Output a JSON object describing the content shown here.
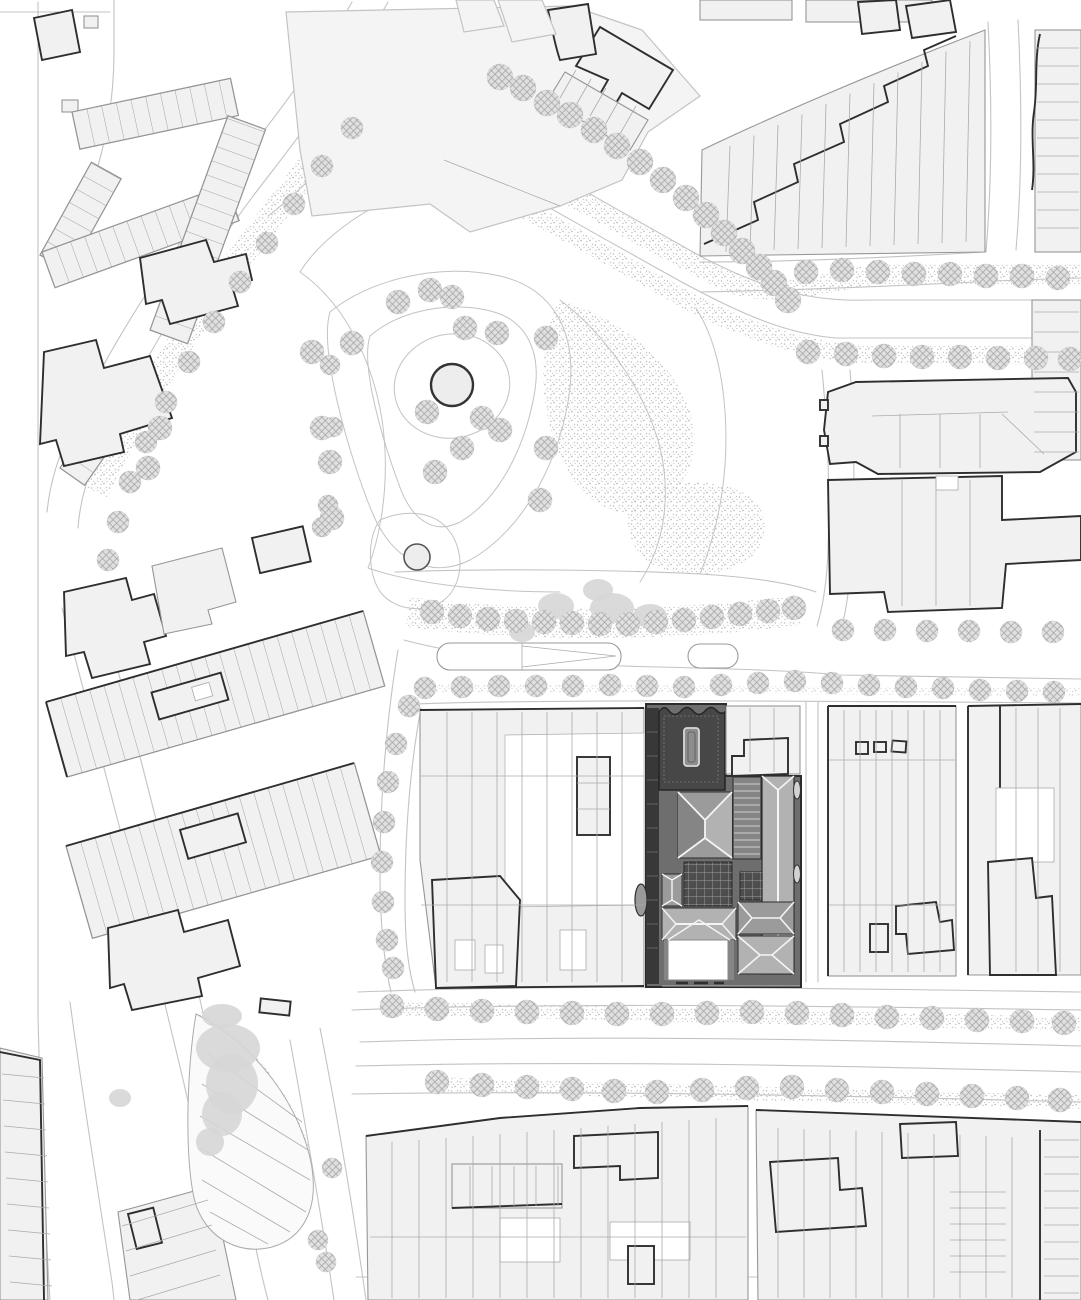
{
  "map": {
    "kind": "architectural-site-plan",
    "view": "roof-plan-black-and-white",
    "highlighted_site": "dark-roofscape-building-center-right",
    "colors": {
      "paper": "#ffffff",
      "lineLight": "#c3c3c3",
      "lineMid": "#969696",
      "lineBold": "#2e2e2e",
      "blockFill": "#f1f1f1",
      "blockFill2": "#f4f4f4",
      "parcel": "#ababab",
      "treeBase": "#e0e0e0",
      "treeHatch": "#a5a5a5",
      "blob": "#d6d6d6",
      "stipple": "#bdbdbd",
      "siteBase": "#6e6e6e",
      "siteDark": "#474747",
      "siteDarker": "#383838",
      "roofLight": "#b2b2b2",
      "roofMid": "#9b9b9b",
      "roofDark": "#858585",
      "plaid": "#4e4e4e",
      "plaidLine": "#9e9e9e",
      "ridge": "#f4f4f4"
    },
    "trees": {
      "rows": [
        {
          "id": "avenue-diagonal",
          "r": 13,
          "pts": [
            [
              500,
              77
            ],
            [
              523,
              88
            ],
            [
              547,
              103
            ],
            [
              570,
              115
            ],
            [
              594,
              130
            ],
            [
              617,
              146
            ],
            [
              640,
              162
            ],
            [
              663,
              180
            ],
            [
              686,
              198
            ],
            [
              706,
              215
            ],
            [
              724,
              233
            ],
            [
              742,
              251
            ],
            [
              759,
              267
            ],
            [
              774,
              283
            ],
            [
              788,
              300
            ]
          ]
        },
        {
          "id": "avenue-north-verge",
          "r": 12,
          "pts": [
            [
              806,
              272
            ],
            [
              842,
              270
            ],
            [
              878,
              272
            ],
            [
              914,
              274
            ],
            [
              950,
              274
            ],
            [
              986,
              276
            ],
            [
              1022,
              276
            ],
            [
              1058,
              278
            ]
          ]
        },
        {
          "id": "avenue-south-verge",
          "r": 12,
          "pts": [
            [
              808,
              352
            ],
            [
              846,
              354
            ],
            [
              884,
              356
            ],
            [
              922,
              357
            ],
            [
              960,
              357
            ],
            [
              998,
              358
            ],
            [
              1036,
              358
            ],
            [
              1070,
              359
            ]
          ]
        },
        {
          "id": "canal-bank",
          "r": 11,
          "pts": [
            [
              352,
              128
            ],
            [
              322,
              166
            ],
            [
              294,
              204
            ],
            [
              267,
              243
            ],
            [
              240,
              282
            ],
            [
              214,
              322
            ],
            [
              189,
              362
            ],
            [
              166,
              402
            ],
            [
              146,
              442
            ],
            [
              130,
              482
            ],
            [
              118,
              522
            ],
            [
              108,
              560
            ]
          ]
        },
        {
          "id": "canal-east-bank",
          "r": 10,
          "pts": [
            [
              330,
              365
            ],
            [
              333,
              427
            ],
            [
              328,
              505
            ],
            [
              322,
              527
            ]
          ]
        },
        {
          "id": "park",
          "r": 12,
          "pts": [
            [
              430,
              290
            ],
            [
              452,
              297
            ],
            [
              398,
              302
            ],
            [
              352,
              343
            ],
            [
              312,
              352
            ],
            [
              465,
              328
            ],
            [
              497,
              333
            ],
            [
              546,
              338
            ],
            [
              482,
              418
            ],
            [
              427,
              412
            ],
            [
              462,
              448
            ],
            [
              500,
              430
            ],
            [
              546,
              448
            ],
            [
              435,
              472
            ],
            [
              322,
              428
            ],
            [
              330,
              462
            ],
            [
              332,
              518
            ],
            [
              540,
              500
            ],
            [
              160,
              428
            ],
            [
              148,
              468
            ]
          ]
        },
        {
          "id": "park-boulevard",
          "r": 12,
          "pts": [
            [
              432,
              612
            ],
            [
              460,
              616
            ],
            [
              488,
              619
            ],
            [
              516,
              621
            ],
            [
              544,
              622
            ],
            [
              572,
              623
            ],
            [
              600,
              624
            ],
            [
              628,
              624
            ],
            [
              656,
              622
            ],
            [
              684,
              620
            ],
            [
              712,
              617
            ],
            [
              740,
              614
            ],
            [
              768,
              611
            ],
            [
              794,
              608
            ]
          ]
        },
        {
          "id": "site-street",
          "r": 11,
          "pts": [
            [
              425,
              688
            ],
            [
              462,
              687
            ],
            [
              499,
              686
            ],
            [
              536,
              686
            ],
            [
              573,
              686
            ],
            [
              610,
              685
            ],
            [
              647,
              686
            ],
            [
              684,
              687
            ],
            [
              721,
              685
            ],
            [
              758,
              683
            ],
            [
              795,
              681
            ],
            [
              832,
              683
            ],
            [
              869,
              685
            ],
            [
              906,
              687
            ],
            [
              943,
              688
            ],
            [
              980,
              690
            ],
            [
              1017,
              691
            ],
            [
              1054,
              692
            ]
          ]
        },
        {
          "id": "west-leg-street",
          "r": 11,
          "pts": [
            [
              409,
              706
            ],
            [
              396,
              744
            ],
            [
              388,
              782
            ],
            [
              384,
              822
            ],
            [
              382,
              862
            ],
            [
              383,
              902
            ],
            [
              387,
              940
            ],
            [
              393,
              968
            ]
          ]
        },
        {
          "id": "right-blocks-street",
          "r": 11,
          "pts": [
            [
              843,
              630
            ],
            [
              885,
              630
            ],
            [
              927,
              631
            ],
            [
              969,
              631
            ],
            [
              1011,
              632
            ],
            [
              1053,
              632
            ]
          ]
        },
        {
          "id": "boulevard-north-row",
          "r": 12,
          "pts": [
            [
              392,
              1006
            ],
            [
              437,
              1009
            ],
            [
              482,
              1011
            ],
            [
              527,
              1012
            ],
            [
              572,
              1013
            ],
            [
              617,
              1014
            ],
            [
              662,
              1014
            ],
            [
              707,
              1013
            ],
            [
              752,
              1012
            ],
            [
              797,
              1013
            ],
            [
              842,
              1015
            ],
            [
              887,
              1017
            ],
            [
              932,
              1018
            ],
            [
              977,
              1020
            ],
            [
              1022,
              1021
            ],
            [
              1064,
              1023
            ]
          ]
        },
        {
          "id": "boulevard-south-row",
          "r": 12,
          "pts": [
            [
              437,
              1082
            ],
            [
              482,
              1085
            ],
            [
              527,
              1087
            ],
            [
              572,
              1089
            ],
            [
              614,
              1091
            ],
            [
              657,
              1092
            ],
            [
              702,
              1090
            ],
            [
              747,
              1088
            ],
            [
              792,
              1087
            ],
            [
              837,
              1090
            ],
            [
              882,
              1092
            ],
            [
              927,
              1094
            ],
            [
              972,
              1096
            ],
            [
              1017,
              1098
            ],
            [
              1060,
              1100
            ]
          ]
        },
        {
          "id": "southwest-street",
          "r": 10,
          "pts": [
            [
              332,
              1168
            ],
            [
              318,
              1240
            ],
            [
              326,
              1262
            ]
          ]
        }
      ]
    },
    "blobs": [
      [
        222,
        1016,
        20,
        12
      ],
      [
        228,
        1048,
        32,
        24
      ],
      [
        232,
        1084,
        26,
        30
      ],
      [
        222,
        1114,
        20,
        22
      ],
      [
        210,
        1142,
        14,
        14
      ],
      [
        556,
        606,
        18,
        13
      ],
      [
        612,
        608,
        22,
        15
      ],
      [
        522,
        632,
        13,
        10
      ],
      [
        650,
        616,
        17,
        12
      ],
      [
        598,
        590,
        15,
        11
      ],
      [
        120,
        1098,
        11,
        9
      ]
    ],
    "parcels": [
      {
        "id": "topright-slant",
        "p1": [
          730,
          146
        ],
        "p2": [
          726,
          252
        ],
        "d1": [
          24,
          -10.5
        ],
        "d2": [
          24,
          -1
        ],
        "n": 11
      },
      {
        "id": "topright-strip",
        "p1": [
          1037,
          48
        ],
        "p2": [
          1079,
          48
        ],
        "d1": [
          0,
          18
        ],
        "d2": [
          0,
          18
        ],
        "n": 11
      },
      {
        "id": "central-vert",
        "p1": [
          447,
          712
        ],
        "p2": [
          447,
          982
        ],
        "d1": [
          25,
          0
        ],
        "d2": [
          25,
          0
        ],
        "n": 8
      },
      {
        "id": "central-horiz",
        "p1": [
          421,
          776
        ],
        "p2": [
          644,
          776
        ],
        "d1": [
          0,
          129
        ],
        "d2": [
          0,
          129
        ],
        "n": 2
      },
      {
        "id": "rightA-vert",
        "p1": [
          844,
          710
        ],
        "p2": [
          844,
          972
        ],
        "d1": [
          16,
          0
        ],
        "d2": [
          16,
          0
        ],
        "n": 7
      },
      {
        "id": "rightA-horiz",
        "p1": [
          829,
          760
        ],
        "p2": [
          955,
          760
        ],
        "d1": [
          0,
          145
        ],
        "d2": [
          0,
          145
        ],
        "n": 2
      },
      {
        "id": "rightB-vert",
        "p1": [
          1016,
          708
        ],
        "p2": [
          1016,
          972
        ],
        "d1": [
          22,
          0
        ],
        "d2": [
          22,
          0
        ],
        "n": 3
      },
      {
        "id": "bottomcenter-vert",
        "p1": [
          392,
          1142
        ],
        "p2": [
          392,
          1298
        ],
        "d1": [
          27,
          -2
        ],
        "d2": [
          27,
          0
        ],
        "n": 13
      },
      {
        "id": "bottomcenter-horiz",
        "p1": [
          370,
          1237
        ],
        "p2": [
          746,
          1237
        ],
        "d1": [
          0,
          0
        ],
        "d2": [
          0,
          0
        ],
        "n": 1
      },
      {
        "id": "bottomright-vert",
        "p1": [
          778,
          1128
        ],
        "p2": [
          778,
          1298
        ],
        "d1": [
          26,
          1
        ],
        "d2": [
          26,
          0
        ],
        "n": 10
      },
      {
        "id": "farright-bottom",
        "p1": [
          1044,
          1140
        ],
        "p2": [
          1079,
          1140
        ],
        "d1": [
          0,
          17
        ],
        "d2": [
          0,
          17
        ],
        "n": 10
      },
      {
        "id": "leftstrip-bottom",
        "p1": [
          2,
          1074
        ],
        "p2": [
          44,
          1078
        ],
        "d1": [
          1,
          26
        ],
        "d2": [
          1,
          26
        ],
        "n": 9
      },
      {
        "id": "bl-mid-rungs",
        "p1": [
          122,
          1226
        ],
        "p2": [
          208,
          1200
        ],
        "d1": [
          4,
          25
        ],
        "d2": [
          4,
          25
        ],
        "n": 4
      },
      {
        "id": "tc-strip-rungs",
        "p1": [
          576,
          70
        ],
        "p2": [
          560,
          98
        ],
        "d1": [
          15,
          9
        ],
        "d2": [
          15,
          9
        ],
        "n": 5
      },
      {
        "id": "bld1-vert",
        "p1": [
          900,
          414
        ],
        "p2": [
          900,
          468
        ],
        "d1": [
          40,
          0
        ],
        "d2": [
          40,
          0
        ],
        "n": 3
      },
      {
        "id": "bld2-vert",
        "p1": [
          902,
          480
        ],
        "p2": [
          902,
          606
        ],
        "d1": [
          34,
          0
        ],
        "d2": [
          34,
          0
        ],
        "n": 3
      },
      {
        "id": "ne-neighbor",
        "p1": [
          750,
          708
        ],
        "p2": [
          750,
          772
        ],
        "d1": [
          24,
          0
        ],
        "d2": [
          24,
          0
        ],
        "n": 2
      },
      {
        "id": "gardens",
        "p1": [
          950,
          1192
        ],
        "p2": [
          1006,
          1192
        ],
        "d1": [
          0,
          16
        ],
        "d2": [
          0,
          16
        ],
        "n": 6
      },
      {
        "id": "rightstrip-top",
        "p1": [
          1034,
          312
        ],
        "p2": [
          1079,
          312
        ],
        "d1": [
          0,
          20
        ],
        "d2": [
          0,
          20
        ],
        "n": 8
      },
      {
        "id": "tiny-strip-rungs",
        "p1": [
          470,
          1166
        ],
        "p2": [
          470,
          1206
        ],
        "d1": [
          22,
          0
        ],
        "d2": [
          22,
          0
        ],
        "n": 5
      },
      {
        "id": "site-strip-ticks",
        "p1": [
          647,
          732
        ],
        "p2": [
          658,
          732
        ],
        "d1": [
          0,
          24
        ],
        "d2": [
          0,
          24
        ],
        "n": 10,
        "color": "#787878",
        "w": 0.7
      },
      {
        "id": "striped-roof",
        "p1": [
          734,
          784
        ],
        "p2": [
          760,
          784
        ],
        "d1": [
          0,
          7
        ],
        "d2": [
          0,
          7
        ],
        "n": 11,
        "color": "#cfcfcf",
        "w": 0.9
      }
    ]
  }
}
